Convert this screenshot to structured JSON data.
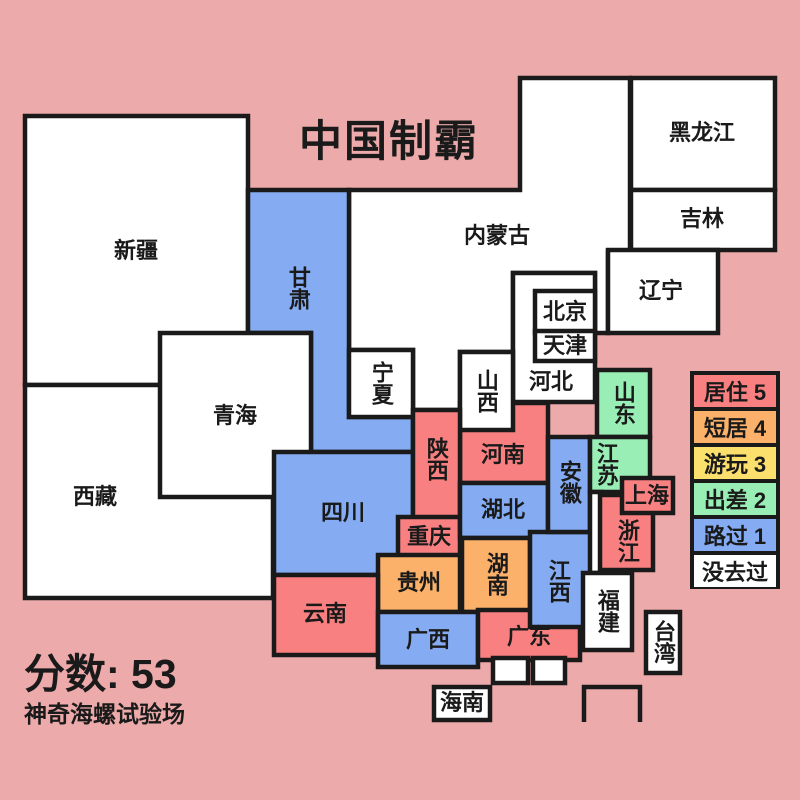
{
  "header": {
    "title": "中国制霸"
  },
  "footer": {
    "score": "分数: 53",
    "watermark": "神奇海螺试验场"
  },
  "palette": {
    "background": "#ECAAAA",
    "ink": "#1A1A1A",
    "red": "#F98080",
    "orange": "#FBB169",
    "yellow": "#FCE06E",
    "green": "#99EEB5",
    "blue": "#85ACF2",
    "white": "#FFFFFF"
  },
  "legend": {
    "items": [
      {
        "label": "居住 5",
        "color": "#F98080"
      },
      {
        "label": "短居 4",
        "color": "#FBB169"
      },
      {
        "label": "游玩 3",
        "color": "#FCE06E"
      },
      {
        "label": "出差 2",
        "color": "#99EEB5"
      },
      {
        "label": "路过 1",
        "color": "#85ACF2"
      },
      {
        "label": "没去过",
        "color": "#FFFFFF"
      }
    ]
  },
  "provinces": {
    "xinjiang": {
      "name": "新疆",
      "status": "没去过"
    },
    "xizang": {
      "name": "西藏",
      "status": "没去过"
    },
    "qinghai": {
      "name": "青海",
      "status": "没去过"
    },
    "gansu": {
      "name": "甘肃",
      "status": "路过 1"
    },
    "neimenggu": {
      "name": "内蒙古",
      "status": "没去过"
    },
    "heilongjiang": {
      "name": "黑龙江",
      "status": "没去过"
    },
    "jilin": {
      "name": "吉林",
      "status": "没去过"
    },
    "liaoning": {
      "name": "辽宁",
      "status": "没去过"
    },
    "beijing": {
      "name": "北京",
      "status": "没去过"
    },
    "tianjin": {
      "name": "天津",
      "status": "没去过"
    },
    "hebei": {
      "name": "河北",
      "status": "没去过"
    },
    "ningxia": {
      "name": "宁夏",
      "status": "没去过"
    },
    "shanxi": {
      "name": "山西",
      "status": "没去过"
    },
    "shaanxi": {
      "name": "陕西",
      "status": "居住 5"
    },
    "henan": {
      "name": "河南",
      "status": "居住 5"
    },
    "shandong": {
      "name": "山东",
      "status": "出差 2"
    },
    "jiangsu": {
      "name": "江苏",
      "status": "出差 2"
    },
    "anhui": {
      "name": "安徽",
      "status": "路过 1"
    },
    "shanghai": {
      "name": "上海",
      "status": "居住 5"
    },
    "zhejiang": {
      "name": "浙江",
      "status": "居住 5"
    },
    "hubei": {
      "name": "湖北",
      "status": "路过 1"
    },
    "sichuan": {
      "name": "四川",
      "status": "路过 1"
    },
    "chongqing": {
      "name": "重庆",
      "status": "居住 5"
    },
    "guizhou": {
      "name": "贵州",
      "status": "短居 4"
    },
    "hunan": {
      "name": "湖南",
      "status": "短居 4"
    },
    "jiangxi": {
      "name": "江西",
      "status": "路过 1"
    },
    "yunnan": {
      "name": "云南",
      "status": "居住 5"
    },
    "guangxi": {
      "name": "广西",
      "status": "路过 1"
    },
    "guangdong": {
      "name": "广东",
      "status": "居住 5"
    },
    "fujian": {
      "name": "福建",
      "status": "没去过"
    },
    "taiwan": {
      "name": "台湾",
      "status": "没去过"
    },
    "hainan": {
      "name": "海南",
      "status": "没去过"
    }
  }
}
